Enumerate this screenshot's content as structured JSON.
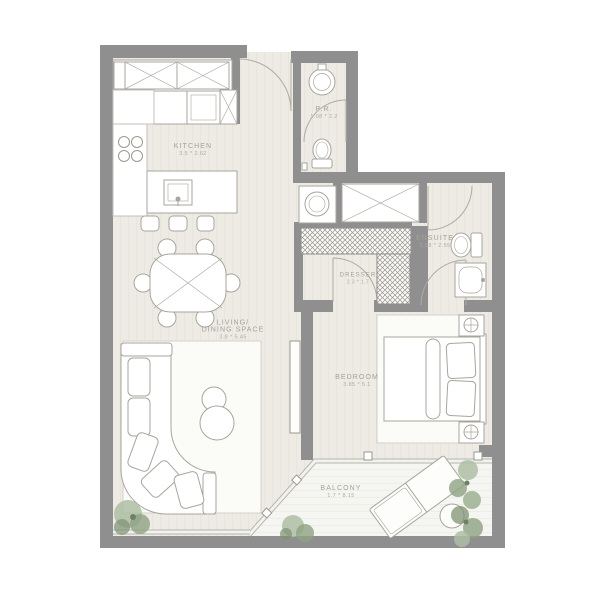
{
  "rooms": {
    "kitchen": {
      "name": "KITCHEN",
      "dims": "3.5 * 2.62"
    },
    "pr": {
      "name": "P.R.",
      "dims": "1.08 * 2.2"
    },
    "ensuite": {
      "name": "ENSUITE",
      "dims": "1.58 * 2.55"
    },
    "dresser": {
      "name": "DRESSER",
      "dims": "2.3 * 1.7"
    },
    "living": {
      "name_line1": "LIVING/",
      "name_line2": "DINING SPACE",
      "dims": "3.8 * 5.45"
    },
    "bedroom": {
      "name": "BEDROOM",
      "dims": "3.85 * 5.1"
    },
    "balcony": {
      "name": "BALCONY",
      "dims": "1.7 * 8.15"
    }
  },
  "colors": {
    "wall": "#8f8f8f",
    "floor": "#edebe4",
    "balcony_floor": "#f5f5f1",
    "fixture_outline": "#a8a59d",
    "label_text": "#a3a098",
    "plant_green": "#9cae90"
  }
}
